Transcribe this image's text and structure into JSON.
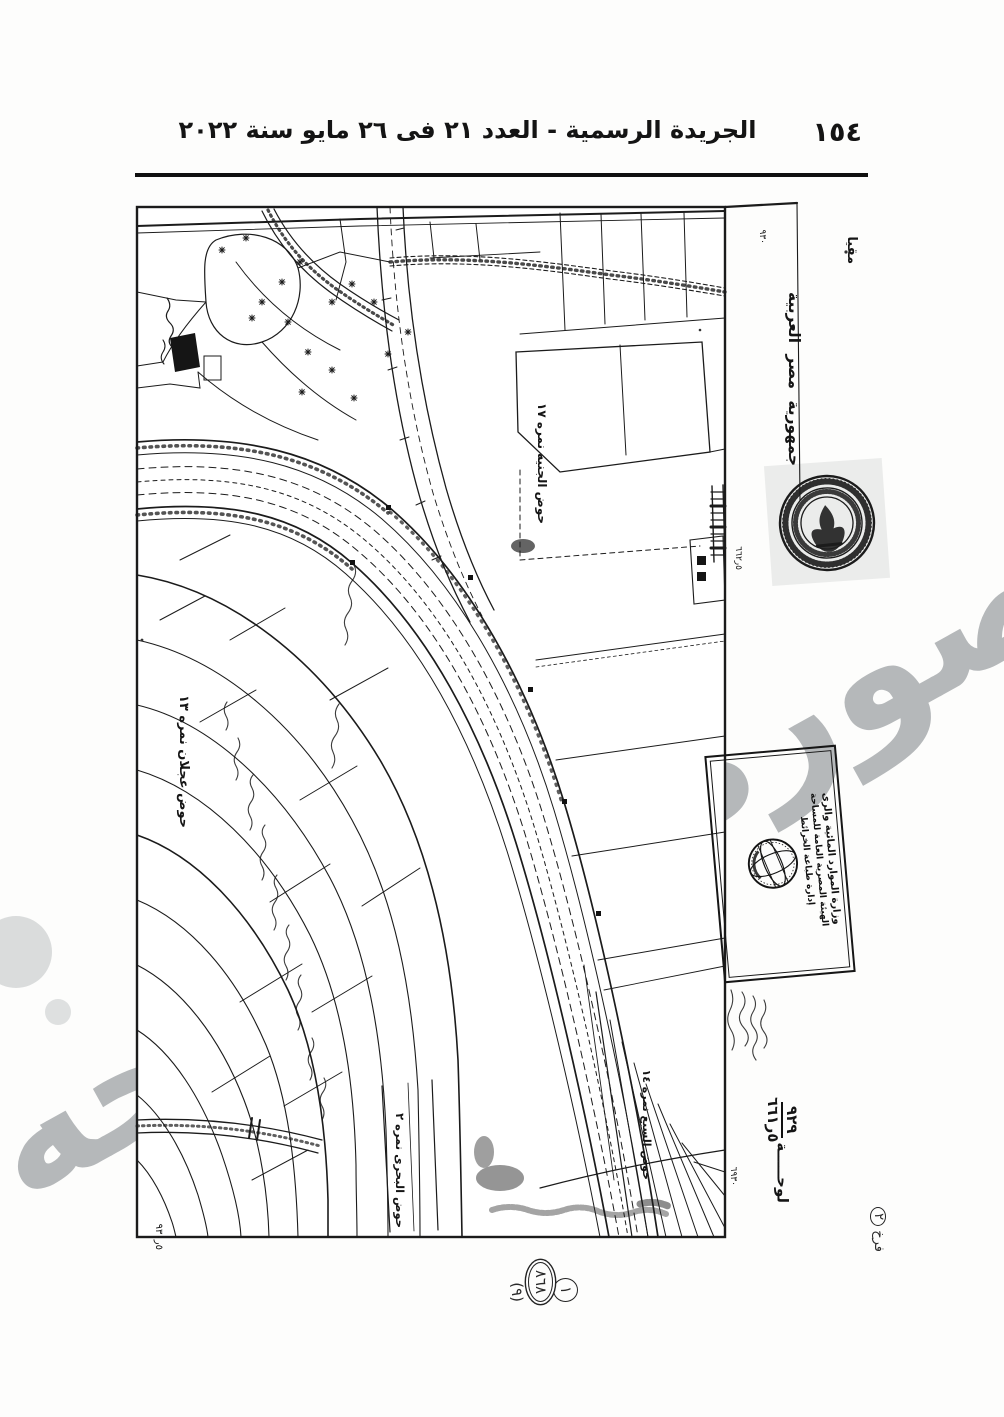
{
  "page": {
    "header_title": "الجريدة الرسمية - العدد ٢١ فى ٢٦ مايو سنة ٢٠٢٢",
    "page_number": "١٥٤"
  },
  "map": {
    "country_label": "جمهورية مصر العربية",
    "scale_label_partial": "مقيا",
    "sheet": {
      "word": "لوحـــــة",
      "numerator": "٩٢٩",
      "denominator": "٥ر٦٦١",
      "page_note": "فرخ",
      "page_note_number": "٢"
    },
    "grid_refs": {
      "top_right": "٩٣٠",
      "mid_right": "٥ر٦٦٢",
      "bottom_right": "٦٩٣٠",
      "bottom_left": "٥ر٩٣٠"
    },
    "hod_labels": {
      "genia": "حوض الجنيه نمره ١٧",
      "aglan": "حوض عجلان نمره ١٣",
      "bahari": "حوض البحرى نمره ٢",
      "sabaa": "حوض السبع نمره ١٤"
    },
    "handwritten_annotations": {
      "circle_1": "١",
      "oval_2": "٨٦٨",
      "paren_3": "(٩)"
    },
    "stamp": {
      "line1": "وزارة الموارد المائية والرى",
      "line2": "الهيئة المصرية العامة للمساحة",
      "line3": "إدارة طباعة الخرائط"
    },
    "watermark_text": "صوره المساحه"
  }
}
